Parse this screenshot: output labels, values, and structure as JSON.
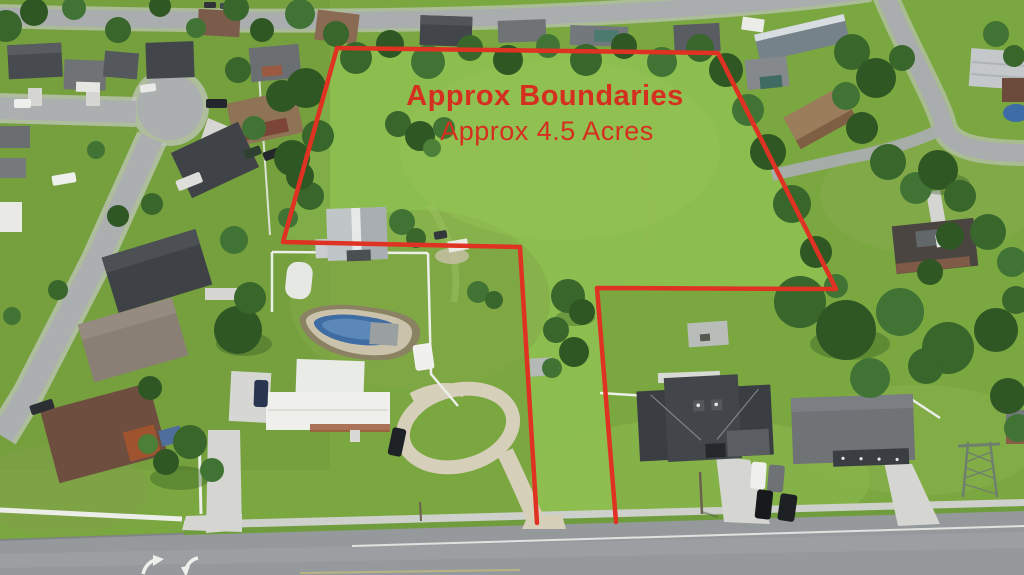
{
  "annotation": {
    "title": "Approx Boundaries",
    "subtitle": "Approx 4.5 Acres",
    "acres_value": "4.5",
    "text_color": "#d5301f",
    "line_color": "#e03222",
    "boundary_points": [
      [
        616,
        522
      ],
      [
        597,
        288
      ],
      [
        836,
        289
      ],
      [
        718,
        53
      ],
      [
        337,
        48
      ],
      [
        283,
        242
      ],
      [
        520,
        247
      ],
      [
        537,
        523
      ]
    ]
  },
  "photo": {
    "type": "aerial-drone-photo",
    "subject": "vacant-land-parcel-with-boundary-overlay",
    "palette": {
      "field_green": "#8cbd4f",
      "grass_green": "#7aa73f",
      "tree_green": "#35622a",
      "road_gray": "#95999b",
      "street_gray": "#abafb0",
      "sidewalk": "#cdd0cb",
      "concrete": "#d5d6d2",
      "gravel": "#d6cfba",
      "pool_blue": "#3e6ca3",
      "roof_dark": "#3f4347",
      "roof_white": "#eff0ec",
      "fence_white": "#eceee9"
    }
  }
}
